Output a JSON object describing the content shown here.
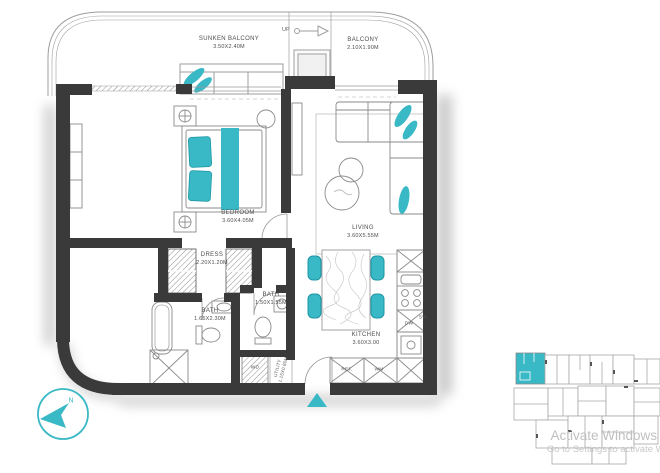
{
  "colors": {
    "accent": "#39b8c5",
    "wall": "#3a3a3a"
  },
  "rooms": {
    "sunken_balcony": {
      "label": "SUNKEN BALCONY",
      "dims": "3.50X2.40M"
    },
    "balcony": {
      "label": "BALCONY",
      "dims": "2.10X1.90M"
    },
    "bedroom": {
      "label": "BEDROOM",
      "dims": "3.60X4.05M"
    },
    "living": {
      "label": "LIVING",
      "dims": "3.60X5.55M"
    },
    "dress": {
      "label": "DRESS",
      "dims": "2.20X1.20M"
    },
    "bath_main": {
      "label": "BATH",
      "dims": "1.65X2.30M"
    },
    "bath_guest": {
      "label": "BATH",
      "dims": "1.50X1.55M"
    },
    "utility": {
      "label": "UTILITY",
      "dims": "1.15X0.80M"
    },
    "kitchen": {
      "label": "KITCHEN",
      "dims": "3.60X3.00"
    }
  },
  "markers": {
    "up": "UP",
    "north": "N",
    "wd": "WD",
    "ref": "REF.",
    "wm": "WM",
    "dw": "DW",
    "sw": "SW"
  },
  "watermark": {
    "line1": "Activate Windows",
    "line2": "Go to Settings to activate Win"
  }
}
